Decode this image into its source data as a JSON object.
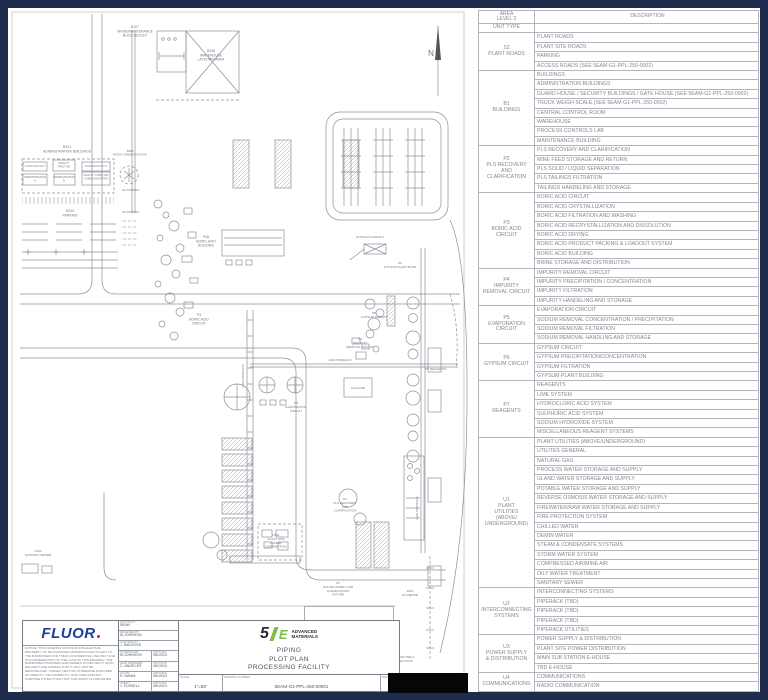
{
  "area_table": {
    "header": {
      "area": "AREA\nLEVEL 2",
      "unit_type": "UNIT TYPE",
      "description": "DESCRIPTION"
    },
    "groups": [
      {
        "code": "S2",
        "name": "PLANT ROADS",
        "rows": [
          "PLANT ROADS",
          "PLANT SITE ROADS",
          "PARKING",
          "ACCESS ROADS (SEE 5EAM-G1-PPL-250-0002)"
        ]
      },
      {
        "code": "B1",
        "name": "BUILDINGS",
        "rows": [
          "BUILDINGS",
          "ADMINISTRATION BUILDINGS",
          "GUARD HOUSE / SECURITY BUILDINGS / GATE HOUSE (SEE 5EAM-G1-PPL-250-0002)",
          "TRUCK WEIGH SCALE (SEE 5EAM-G1-PPL-250-0002)",
          "CENTRAL CONTROL ROOM",
          "WAREHOUSE",
          "PROCESS CONTROLS LAB",
          "MAINTENANCE BUILDING"
        ]
      },
      {
        "code": "P2",
        "name": "PLS RECOVERY\nAND\nCLARIFICATION",
        "rows": [
          "PLS RECOVERY AND CLARIFICATION",
          "MINE FEED STORAGE AND RETURN",
          "PLS SOLID / LIQUID SEPARATION",
          "PLS TAILINGS FILTRATION",
          "TAILINGS HANDELING AND STORAGE"
        ]
      },
      {
        "code": "P3",
        "name": "BORIC ACID\nCIRCUIT",
        "rows": [
          "BORIC ACID CIRCUIT",
          "BORIC ACID CRYSTALLIZATION",
          "BORIC ACID FILTRATION AND WASHING",
          "BORIC ACID RECRYSTALLIZATION AND DISSOLUTION",
          "BORIC ACID DRYING",
          "BORIC ACID PRODUCT PACKING & LOADOUT SYSTEM",
          "BORIC ACID BUILDING",
          "BRINE STORAGE AND DISTRIBUTION"
        ]
      },
      {
        "code": "P4",
        "name": "IMPURITY\nREMOVAL CIRCUIT",
        "rows": [
          "IMPURITY REMOVAL CIRCUIT",
          "IMPURITY PRECIPITATION / CONCENTRATION",
          "IMPURITY FILTRATION",
          "IMPURITY HANDELING AND STORAGE"
        ]
      },
      {
        "code": "P5",
        "name": "EVAPORATION\nCIRCUIT",
        "rows": [
          "EVAPORATION CIRCUIT",
          "SODIUM REMOVAL CONCENTRATION / PRECIPITATION",
          "SODIUM REMOVAL FILTRATION",
          "SODIUM REMOVAL HANDLING AND STORAGE"
        ]
      },
      {
        "code": "P6",
        "name": "GYPSUM CIRCUIT",
        "rows": [
          "GYPSUM CIRCUIT",
          "GYPSUM PRECIPITATION/CONCENTRATION",
          "GYPSUM FILTRATION",
          "GYPSUM PLANT BUILDING"
        ]
      },
      {
        "code": "P7",
        "name": "REAGENTS",
        "rows": [
          "REAGENTS",
          "LIME SYSTEM",
          "HYDROCLORIC ACID SYSTEM",
          "SULPHURIC ACID SYSTEM",
          "SODIUM HYDROXIDE SYSTEM",
          "MISCELLANEOUS REAGENT SYSTEMS"
        ]
      },
      {
        "code": "U1",
        "name": "PLANT\nUTILITIES\n(ABOVE/\nUNDERGROUND)",
        "rows": [
          "PLANT UTILITIES (ABOVE/UNDERGROUND)",
          "UTILITES GENERAL",
          "NATURAL GAS",
          "PROCESS WATER STORAGE AND SUPPLY",
          "GLAND WATER STORAGE AND SUPPLY",
          "POTABLE WATER STORAGE AND SUPPLY",
          "REVERSE OSMOSIS WATER STORAGE AND SUPPLY",
          "FIREWATER/RAW WATER STORAGE AND SUPPLY",
          "FIRE PROTECTION SYSTEM",
          "CHILLED WATER",
          "DEMIN WATER",
          "STEAM & CONDENSATE SYSTEMS",
          "STORM WATER SYSTEM",
          "COMPRESSED AIR/MINE AIR",
          "OILY WATER TREATMENT",
          "SANITARY SEWER"
        ]
      },
      {
        "code": "U2",
        "name": "INTERCONNECTING\nSYSTEMS",
        "rows": [
          "INTERCONNECTING SYSTEMS",
          "PIPERACK (TBD)",
          "PIPERACK (TBD)",
          "PIPERACK (TBD)",
          "PIPERACK UTILITIES"
        ]
      },
      {
        "code": "U3",
        "name": "POWER SUPPLY\n& DISTRIBUTION",
        "rows": [
          "POWER SUPPLY & DISTRIBUTION",
          "PLANT SITE POWER DISTRIBUTION",
          "MAIN SUB STATION E-HOUSE",
          "TBD E-HOUSE"
        ]
      },
      {
        "code": "U4",
        "name": "COMMUNICATIONS",
        "rows": [
          "COMMUNICATIONS",
          "RADIO COMMUNICATION"
        ]
      }
    ]
  },
  "plot_plan": {
    "labels": [
      {
        "t": "B107\nWHSE/MAINTENANCE\nBLDG 183'x110'",
        "x": 127,
        "y": 20
      },
      {
        "t": "B108\nWAREHOUSE\nLAYDOWN AREA",
        "x": 203,
        "y": 44
      },
      {
        "t": "N",
        "x": 423,
        "y": 48,
        "fs": 8
      },
      {
        "t": "B101\nADMINISTRATION BUILDINGS",
        "x": 59,
        "y": 140
      },
      {
        "t": "LUNCH FACILITY",
        "x": 27,
        "y": 159,
        "fs": 2.6
      },
      {
        "t": "FACILITY\nFIRST AID",
        "x": 56,
        "y": 156,
        "fs": 2.6
      },
      {
        "t": "CHANGE FACILITY",
        "x": 88,
        "y": 159,
        "fs": 2.6
      },
      {
        "t": "ADMINISTRATION\nA",
        "x": 27,
        "y": 170,
        "fs": 2.6
      },
      {
        "t": "ADMINISTRATION\nB",
        "x": 56,
        "y": 170,
        "fs": 2.6
      },
      {
        "t": "FACILITY FIRST AID/\nCOMMUNICATIONS",
        "x": 88,
        "y": 168,
        "fs": 2.6
      },
      {
        "t": "B105\nRADIO COMMUNICATION",
        "x": 122,
        "y": 144,
        "fs": 2.8
      },
      {
        "t": "EV PARKING",
        "x": 123,
        "y": 183,
        "fs": 2.8
      },
      {
        "t": "B103\nPARKING",
        "x": 62,
        "y": 204
      },
      {
        "t": "EV PARKING",
        "x": 123,
        "y": 205,
        "fs": 2.8
      },
      {
        "t": "P3A\nBORIC ACID\nBUILDING",
        "x": 198,
        "y": 230
      },
      {
        "t": "GYPSUM LOADOUT",
        "x": 362,
        "y": 230,
        "fs": 3
      },
      {
        "t": "P6\nGYPSUM PLANT BLDG",
        "x": 392,
        "y": 256,
        "fs": 3
      },
      {
        "t": "P3\nBORIC ACID\nCIRCUIT",
        "x": 191,
        "y": 308
      },
      {
        "t": "P6\nGYPSUM CIRCUIT",
        "x": 366,
        "y": 306,
        "fs": 3
      },
      {
        "t": "P4\nIMPURITY\nREMOVAL CIRCUIT",
        "x": 352,
        "y": 332,
        "fs": 3
      },
      {
        "t": "P5\nEVAPORATION\nCIRCUIT",
        "x": 288,
        "y": 396,
        "fs": 3
      },
      {
        "t": "E-HOUSE",
        "x": 350,
        "y": 381,
        "fs": 3
      },
      {
        "t": "U203 PIPERACK",
        "x": 332,
        "y": 353,
        "fs": 3
      },
      {
        "t": "U202 PIPERACK",
        "x": 236,
        "y": 368,
        "r": -90,
        "fs": 3
      },
      {
        "t": "U201 PIPERACK",
        "x": 410,
        "y": 500,
        "r": -90,
        "fs": 3
      },
      {
        "t": "P7 REAGENTS",
        "x": 428,
        "y": 362,
        "fs": 3
      },
      {
        "t": "U301\nPLANT SITE\nPOWER\nDISTRIBUTION",
        "x": 268,
        "y": 528,
        "fs": 3
      },
      {
        "t": "P2\nPLS RECOVERY\nAND\nCLARIFICATION",
        "x": 337,
        "y": 492,
        "fs": 3
      },
      {
        "t": "P2\nPLS RECOVERY AND\nCLARIFICATION\nFUTURE",
        "x": 330,
        "y": 576,
        "fs": 3
      },
      {
        "t": "U110\nSANITARY SEWER",
        "x": 30,
        "y": 544,
        "fs": 3
      },
      {
        "t": "U112\nSTORM WATER SYSTEM",
        "x": 340,
        "y": 608,
        "fs": 3
      },
      {
        "t": "2021\nNO METER",
        "x": 402,
        "y": 584,
        "fs": 3
      },
      {
        "t": "INJECTION WELL\nJUMPER RACK",
        "x": 394,
        "y": 650,
        "fs": 3
      }
    ]
  },
  "title_block": {
    "fluor_logo": "FLUOR",
    "notice": "NOTICE: THIS DRAWING CONTAINS INTELLECTUAL PROPERTY OF 5E ADVANCED MATERIALS AND IS LENT TO THE BORROWER FOR THEIR CONFIDENTIAL USE ONLY AND IN CONSIDERATION OF THE LOAN OF THIS DRAWING, THE BORROWER PROMISES AND AGREES TO RETURN IT UPON REQUEST AND AGREES THAT IT WILL NOT BE REPRODUCED, COPIED, LENT OR OTHERWISE DISPOSED OF DIRECTLY OR INDIRECTLY, NOR USED FOR ANY PURPOSE OTHER THAN THAT FOR WHICH IS FURNISHED.",
    "sig_rows": [
      {
        "label": "CONTRACT",
        "value": "5EAM"
      },
      {
        "label": "DESIGNED BY",
        "value": "M.JOHNSON"
      },
      {
        "label": "CHECKED BY",
        "value": "J. WALDYKE"
      },
      {
        "label": "SUPERVISOR",
        "value": "M.JOHNSON",
        "date_label": "APP DATE",
        "date": "08/19/24"
      },
      {
        "label": "LEAD ENGINEER",
        "value": "C. ANGELES",
        "date_label": "APP DATE",
        "date": "08/19/24"
      },
      {
        "label": "FLUOR",
        "value": "K. NAMM",
        "date_label": "APP DATE",
        "date": "08/19/24"
      },
      {
        "label": "CLIENT",
        "value": "J. FUSSELL",
        "date_label": "APP DATE",
        "date": "08/19/24"
      }
    ],
    "brand": {
      "five": "5",
      "e": "E",
      "name_line1": "ADVANCED",
      "name_line2": "MATERIALS"
    },
    "title_lines": [
      "PIPING",
      "PLOT PLAN",
      "PROCESSING FACILITY"
    ],
    "scale_label": "SCALE",
    "scale": "1\"=80'",
    "number_label": "DRAWING NUMBER",
    "number": "5EAM-G1-PPL-250-00001",
    "rev_label": "REV",
    "rev": "P"
  },
  "colors": {
    "frame_navy": "#1f2c4e",
    "fluor_blue": "#1c3e96",
    "fluor_red": "#cf1f2e",
    "brand_green": "#7ac143"
  }
}
